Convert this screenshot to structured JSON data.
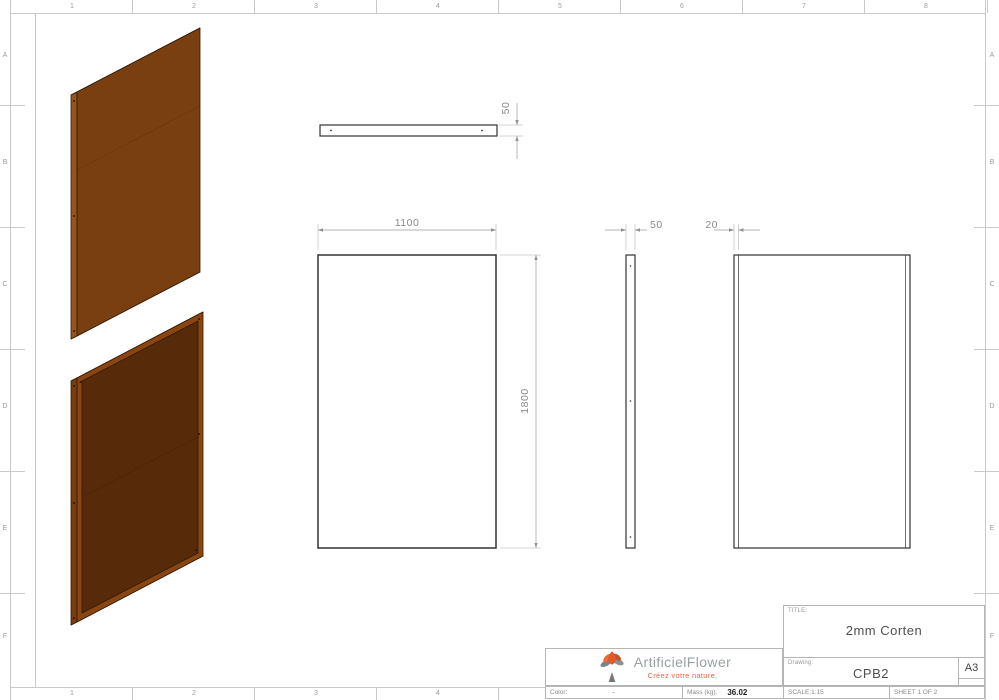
{
  "sheet": {
    "columns": [
      "1",
      "2",
      "3",
      "4",
      "5",
      "6",
      "7",
      "8"
    ],
    "rows": [
      "A",
      "B",
      "C",
      "D",
      "E",
      "F"
    ]
  },
  "views": {
    "top": {
      "thickness_dim": "50"
    },
    "front": {
      "width_dim": "1100",
      "height_dim": "1800"
    },
    "side": {
      "depth_dim": "50"
    },
    "back": {
      "flange_dim": "20"
    }
  },
  "logo": {
    "name": "ArtificielFlower",
    "tagline": "Créez votre nature."
  },
  "title_block": {
    "title_label": "TITLE:",
    "title_value": "2mm Corten",
    "drawing_label": "Drawing:",
    "drawing_value": "CPB2",
    "paper_size": "A3",
    "scale_text": "SCALE:1:15",
    "sheet_text": "SHEET 1 OF 2",
    "color_label": "Color:",
    "color_value": "-",
    "mass_label": "Mass (kg):",
    "mass_value": "36.02"
  },
  "colors": {
    "corten_face": "#7a3f10",
    "corten_top": "#a5611b",
    "corten_side": "#96551a",
    "corten_bottom": "#4f2608",
    "corten_frame": "#8a4511",
    "corten_inner": "#572a0a",
    "outline": "#2f1a06",
    "logo_orange": "#e05a2b",
    "logo_gray": "#7d8488"
  }
}
